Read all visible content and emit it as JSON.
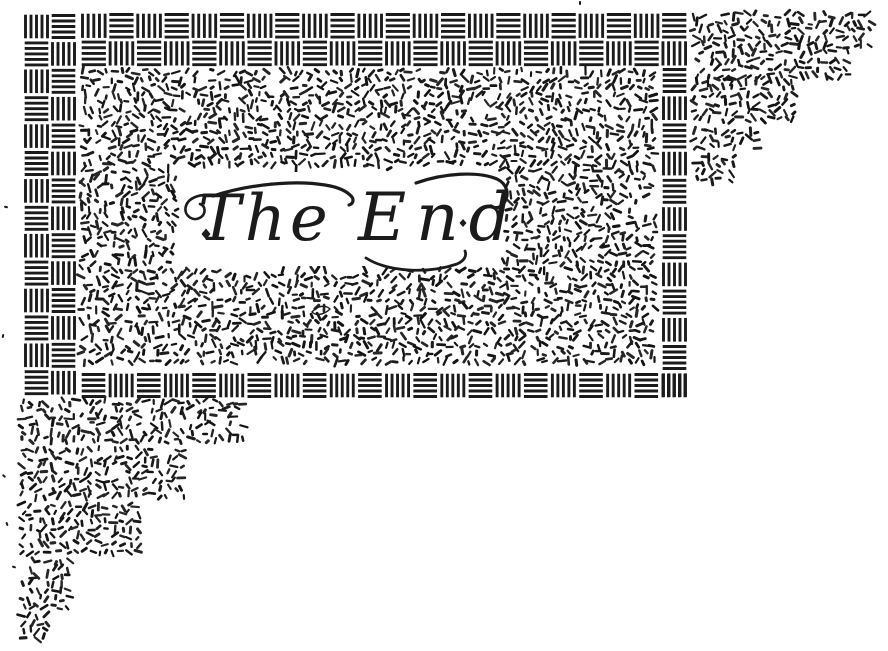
{
  "page": {
    "title": "The End — book ending illustration",
    "kind": "scanned line-art tailpiece"
  },
  "lettering": {
    "words": [
      "The",
      "End"
    ],
    "full_text": "The End"
  },
  "colors": {
    "ink": "#1b1b1b",
    "paper": "#ffffff"
  },
  "patterns": {
    "border": "basket-weave checker of hatched squares",
    "fill": "random short ink dashes (confetti texture)",
    "corners": "staircase confetti blocks at top-right and bottom-left"
  }
}
